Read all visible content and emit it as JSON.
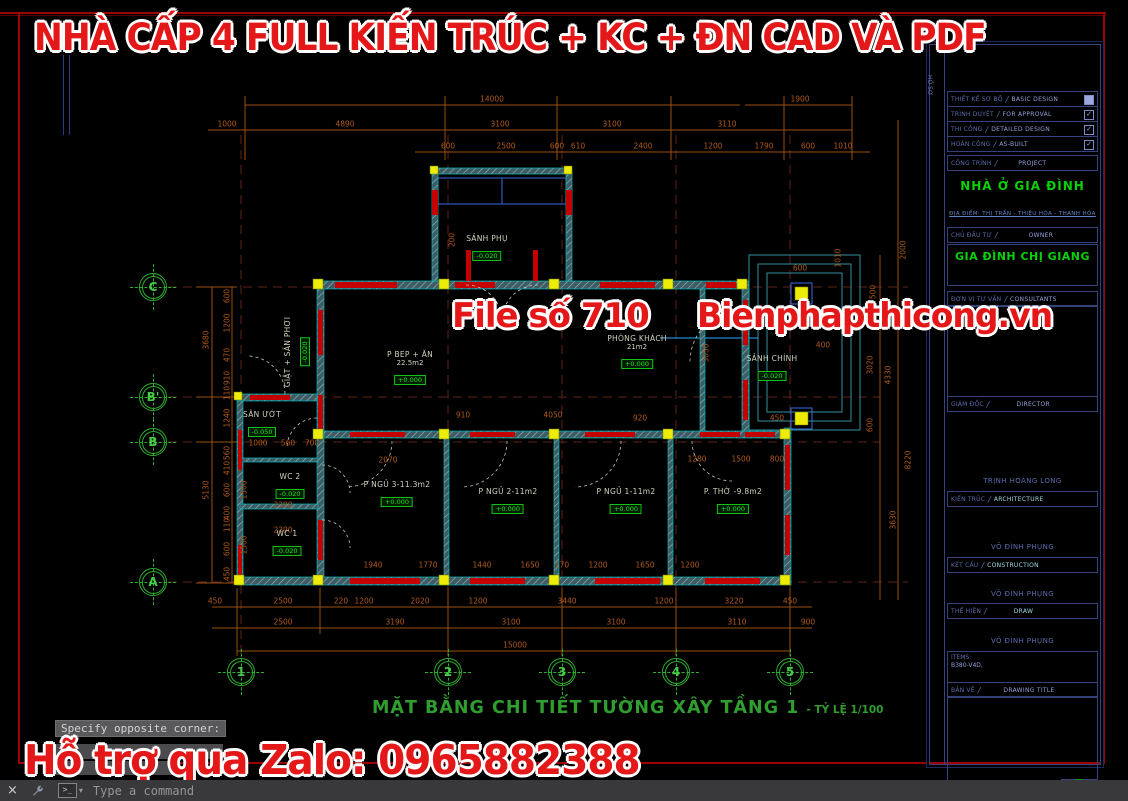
{
  "banners": {
    "top": "NHÀ CẤP 4 FULL KIẾN TRÚC + KC + ĐN CAD VÀ PDF",
    "file": "File số 710",
    "site": "Bienphapthicong.vn",
    "zalo": "Hỗ trợ qua Zalo: 0965882388"
  },
  "plan": {
    "title": "MẶT BẰNG CHI TIẾT TƯỜNG XÂY TẦNG 1",
    "title_suffix": "- TỶ LỆ 1/100",
    "grid_cols": [
      {
        "label": "1",
        "x": 241,
        "y": 672
      },
      {
        "label": "2",
        "x": 448,
        "y": 672
      },
      {
        "label": "3",
        "x": 562,
        "y": 672
      },
      {
        "label": "4",
        "x": 676,
        "y": 672
      },
      {
        "label": "5",
        "x": 790,
        "y": 672
      }
    ],
    "grid_rows": [
      {
        "label": "C",
        "x": 153,
        "y": 287
      },
      {
        "label": "B'",
        "x": 153,
        "y": 397
      },
      {
        "label": "B",
        "x": 153,
        "y": 442
      },
      {
        "label": "A",
        "x": 153,
        "y": 582
      }
    ],
    "rooms": [
      {
        "name": "SẢNH PHỤ",
        "level": "-0.020",
        "x": 487,
        "y": 248
      },
      {
        "name": "GIẶT + SÂN PHƠI",
        "level": "-0.020",
        "x": 297,
        "y": 352,
        "rot": true
      },
      {
        "name": "SÂN ƯỚT",
        "level": "-0.050",
        "x": 262,
        "y": 424
      },
      {
        "name": "P BEP + ĂN",
        "area": "22.5m2",
        "level": "+0.000",
        "x": 410,
        "y": 368
      },
      {
        "name": "PHÒNG KHÁCH",
        "area": "21m2",
        "level": "+0.000",
        "x": 637,
        "y": 352
      },
      {
        "name": "SẢNH CHÍNH",
        "level": "-0.020",
        "x": 772,
        "y": 368
      },
      {
        "name": "WC 2",
        "level": "-0.020",
        "x": 290,
        "y": 486
      },
      {
        "name": "WC 1",
        "level": "-0.020",
        "x": 287,
        "y": 543
      },
      {
        "name": "P NGỦ 3-11.3m2",
        "level": "+0.000",
        "x": 397,
        "y": 494
      },
      {
        "name": "P NGỦ 2-11m2",
        "level": "+0.000",
        "x": 508,
        "y": 501
      },
      {
        "name": "P NGỦ 1-11m2",
        "level": "+0.000",
        "x": 626,
        "y": 501
      },
      {
        "name": "P. THỜ -9.8m2",
        "level": "+0.000",
        "x": 733,
        "y": 501
      }
    ],
    "dims": [
      {
        "t": "14000",
        "x": 492,
        "y": 99
      },
      {
        "t": "1900",
        "x": 800,
        "y": 99
      },
      {
        "t": "1000",
        "x": 227,
        "y": 124
      },
      {
        "t": "4890",
        "x": 345,
        "y": 124
      },
      {
        "t": "3100",
        "x": 500,
        "y": 124
      },
      {
        "t": "3100",
        "x": 612,
        "y": 124
      },
      {
        "t": "3110",
        "x": 727,
        "y": 124
      },
      {
        "t": "600",
        "x": 448,
        "y": 146
      },
      {
        "t": "2500",
        "x": 506,
        "y": 146
      },
      {
        "t": "600",
        "x": 557,
        "y": 146
      },
      {
        "t": "610",
        "x": 578,
        "y": 146
      },
      {
        "t": "2400",
        "x": 643,
        "y": 146
      },
      {
        "t": "1200",
        "x": 713,
        "y": 146
      },
      {
        "t": "1790",
        "x": 764,
        "y": 146
      },
      {
        "t": "600",
        "x": 808,
        "y": 146
      },
      {
        "t": "1010",
        "x": 843,
        "y": 146
      },
      {
        "t": "450",
        "x": 215,
        "y": 601
      },
      {
        "t": "2500",
        "x": 283,
        "y": 601
      },
      {
        "t": "220",
        "x": 341,
        "y": 601
      },
      {
        "t": "1200",
        "x": 364,
        "y": 601
      },
      {
        "t": "2020",
        "x": 420,
        "y": 601
      },
      {
        "t": "1200",
        "x": 478,
        "y": 601
      },
      {
        "t": "3440",
        "x": 567,
        "y": 601
      },
      {
        "t": "1200",
        "x": 664,
        "y": 601
      },
      {
        "t": "3220",
        "x": 734,
        "y": 601
      },
      {
        "t": "450",
        "x": 790,
        "y": 601
      },
      {
        "t": "2500",
        "x": 283,
        "y": 622
      },
      {
        "t": "3190",
        "x": 395,
        "y": 622
      },
      {
        "t": "3100",
        "x": 511,
        "y": 622
      },
      {
        "t": "3100",
        "x": 616,
        "y": 622
      },
      {
        "t": "3110",
        "x": 737,
        "y": 622
      },
      {
        "t": "900",
        "x": 808,
        "y": 622
      },
      {
        "t": "15000",
        "x": 515,
        "y": 645
      },
      {
        "t": "600",
        "x": 227,
        "y": 296,
        "r": 1
      },
      {
        "t": "1200",
        "x": 227,
        "y": 323,
        "r": 1
      },
      {
        "t": "470",
        "x": 227,
        "y": 355,
        "r": 1
      },
      {
        "t": "910",
        "x": 227,
        "y": 378,
        "r": 1
      },
      {
        "t": "110",
        "x": 227,
        "y": 393,
        "r": 1
      },
      {
        "t": "1240",
        "x": 227,
        "y": 418,
        "r": 1
      },
      {
        "t": "560",
        "x": 227,
        "y": 453,
        "r": 1
      },
      {
        "t": "410",
        "x": 227,
        "y": 468,
        "r": 1
      },
      {
        "t": "600",
        "x": 227,
        "y": 490,
        "r": 1
      },
      {
        "t": "400",
        "x": 227,
        "y": 513,
        "r": 1
      },
      {
        "t": "110",
        "x": 227,
        "y": 525,
        "r": 1
      },
      {
        "t": "600",
        "x": 227,
        "y": 549,
        "r": 1
      },
      {
        "t": "450",
        "x": 227,
        "y": 574,
        "r": 1
      },
      {
        "t": "3680",
        "x": 206,
        "y": 340,
        "r": 1
      },
      {
        "t": "5130",
        "x": 206,
        "y": 490,
        "r": 1
      },
      {
        "t": "2000",
        "x": 903,
        "y": 250,
        "r": 1
      },
      {
        "t": "1010",
        "x": 838,
        "y": 258,
        "r": 1
      },
      {
        "t": "600",
        "x": 800,
        "y": 268
      },
      {
        "t": "500",
        "x": 873,
        "y": 292,
        "r": 1
      },
      {
        "t": "3050",
        "x": 706,
        "y": 353,
        "r": 1
      },
      {
        "t": "3020",
        "x": 870,
        "y": 365,
        "r": 1
      },
      {
        "t": "4330",
        "x": 888,
        "y": 375,
        "r": 1
      },
      {
        "t": "8220",
        "x": 908,
        "y": 460,
        "r": 1
      },
      {
        "t": "3630",
        "x": 893,
        "y": 520,
        "r": 1
      },
      {
        "t": "600",
        "x": 870,
        "y": 425,
        "r": 1
      },
      {
        "t": "400",
        "x": 823,
        "y": 345
      },
      {
        "t": "450",
        "x": 777,
        "y": 418
      },
      {
        "t": "910",
        "x": 463,
        "y": 415
      },
      {
        "t": "4050",
        "x": 553,
        "y": 415
      },
      {
        "t": "920",
        "x": 640,
        "y": 418
      },
      {
        "t": "2070",
        "x": 388,
        "y": 460
      },
      {
        "t": "1280",
        "x": 697,
        "y": 459
      },
      {
        "t": "1500",
        "x": 741,
        "y": 459
      },
      {
        "t": "800",
        "x": 777,
        "y": 459
      },
      {
        "t": "1940",
        "x": 373,
        "y": 565
      },
      {
        "t": "1770",
        "x": 428,
        "y": 565
      },
      {
        "t": "1440",
        "x": 482,
        "y": 565
      },
      {
        "t": "1650",
        "x": 530,
        "y": 565
      },
      {
        "t": "170",
        "x": 562,
        "y": 565
      },
      {
        "t": "1200",
        "x": 598,
        "y": 565
      },
      {
        "t": "1650",
        "x": 645,
        "y": 565
      },
      {
        "t": "1200",
        "x": 690,
        "y": 565
      },
      {
        "t": "1000",
        "x": 258,
        "y": 443
      },
      {
        "t": "560",
        "x": 288,
        "y": 443
      },
      {
        "t": "700",
        "x": 312,
        "y": 443
      },
      {
        "t": "2390",
        "x": 283,
        "y": 505
      },
      {
        "t": "2390",
        "x": 283,
        "y": 530
      },
      {
        "t": "1500",
        "x": 244,
        "y": 490,
        "r": 1
      },
      {
        "t": "1500",
        "x": 244,
        "y": 545,
        "r": 1
      },
      {
        "t": "200",
        "x": 452,
        "y": 240,
        "r": 1
      }
    ]
  },
  "title_block": {
    "side_label": "HỒ SƠ",
    "stages": [
      {
        "vn": "THIẾT KẾ SƠ BỘ",
        "en": "BASIC DESIGN",
        "mark": "filled"
      },
      {
        "vn": "TRÌNH DUYỆT",
        "en": "FOR APPROVAL",
        "mark": "check"
      },
      {
        "vn": "THI CÔNG",
        "en": "DETAILED DESIGN",
        "mark": "check"
      },
      {
        "vn": "HOÀN CÔNG",
        "en": "AS-BUILT",
        "mark": "check"
      }
    ],
    "project_vn": "CÔNG TRÌNH",
    "project_en": "PROJECT",
    "project_name": "NHÀ Ở GIA ĐÌNH",
    "address": "ĐỊA ĐIỂM: THỊ TRẤN - THIỆU HÓA - THANH HÓA",
    "owner_vn": "CHỦ ĐẦU TƯ",
    "owner_en": "OWNER",
    "owner_name": "GIA ĐÌNH CHỊ GIANG",
    "consultant_vn": "ĐƠN VỊ TƯ VẤN",
    "consultant_en": "CONSULTANTS",
    "director_vn": "GIÁM ĐỐC",
    "director_en": "DIRECTOR",
    "arch_name": "TRỊNH HOÀNG LONG",
    "arch_vn": "KIẾN TRÚC",
    "arch_en": "ARCHITECTURE",
    "struct_name": "VÕ ĐÌNH PHỤNG",
    "struct_vn": "KẾT CẤU",
    "struct_en": "CONSTRUCTION",
    "draw_name": "VÕ ĐÌNH PHỤNG",
    "draw_vn": "THỂ HIỆN",
    "draw_en": "DRAW",
    "check_name": "VÕ ĐÌNH PHỤNG",
    "items_label": "ITEMS:",
    "items_value": "B380-V4D,",
    "sheet_vn": "BẢN VẼ",
    "sheet_en": "DRAWING TITLE",
    "date": "05-07-24",
    "scale": "1/100",
    "sheet_code": "BV",
    "sheet_no": "01/30"
  },
  "command": {
    "tooltip": "Specify opposite corner:",
    "prompt_glyph": ">_",
    "caret": "▾",
    "close": "×",
    "placeholder": "Type a command"
  }
}
